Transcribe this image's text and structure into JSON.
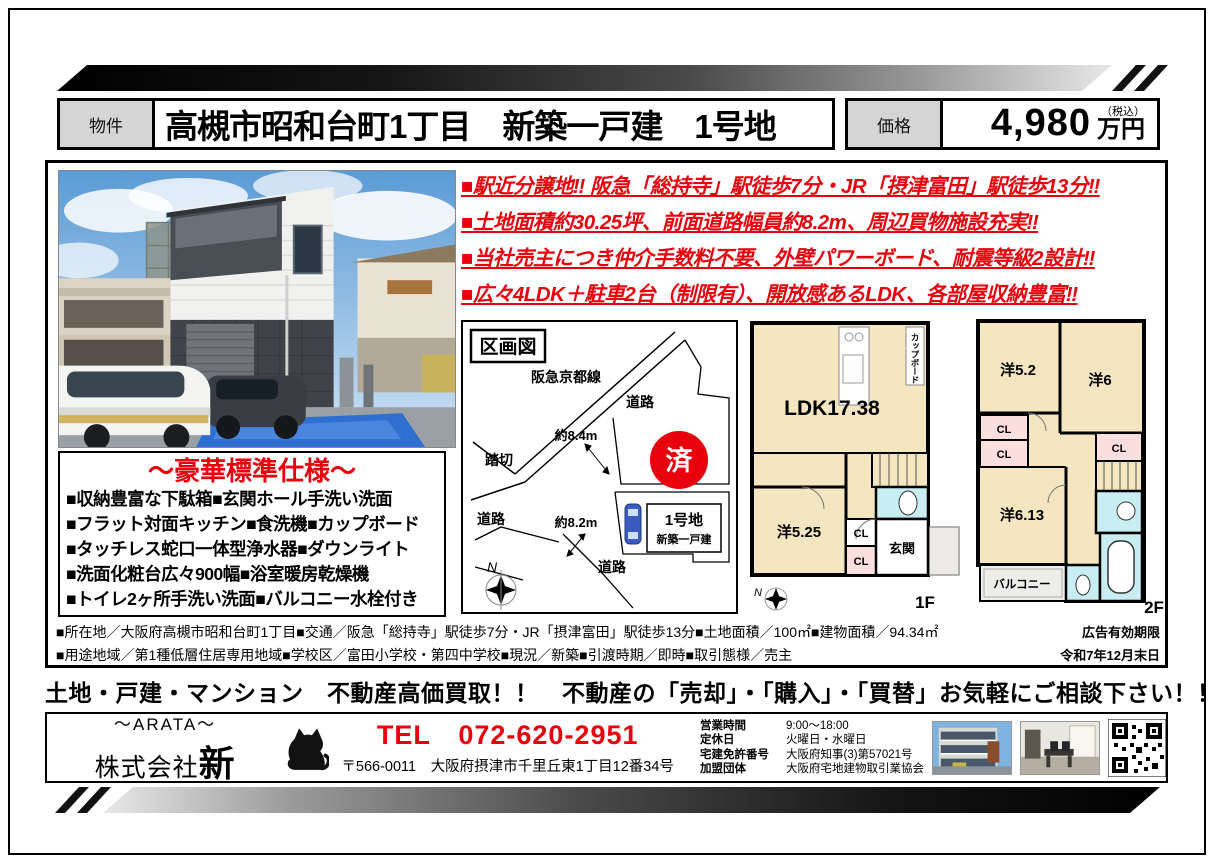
{
  "colors": {
    "accent_red": "#e8000d",
    "label_gray": "#d5d5d5",
    "room_cream": "#f3e6c0",
    "closet_pink": "#fbdede",
    "bath_cyan": "#c9eef2"
  },
  "header": {
    "property_label": "物件",
    "title": "高槻市昭和台町1丁目　新築一戸建　1号地",
    "price_label": "価格",
    "price_value": "4,980",
    "price_unit": "万円",
    "tax_note": "（税込）"
  },
  "highlights": {
    "line1": "■駅近分譲地‼ 阪急「総持寺」駅徒歩7分・JR「摂津富田」駅徒歩13分‼",
    "line2": "■土地面積約30.25坪、前面道路幅員約8.2m、周辺買物施設充実‼",
    "line3": "■当社売主につき仲介手数料不要、外壁パワーボード、耐震等級2設計‼",
    "line4": "■広々4LDK＋駐車2台（制限有）、開放感あるLDK、各部屋収納豊富‼"
  },
  "spec_box": {
    "title": "～豪華標準仕様～",
    "line1": "■収納豊富な下駄箱■玄関ホール手洗い洗面",
    "line2": "■フラット対面キッチン■食洗機■カップボード",
    "line3": "■タッチレス蛇口一体型浄水器■ダウンライト",
    "line4": "■洗面化粧台広々900幅■浴室暖房乾燥機",
    "line5": "■トイレ2ヶ所手洗い洗面■バルコニー水栓付き"
  },
  "site_map": {
    "title": "区画図",
    "railway": "阪急京都線",
    "road_top": "道路",
    "road_left": "道路",
    "road_bottom": "道路",
    "crossing": "踏切",
    "width1": "約8.4m",
    "width2": "約8.2m",
    "sold": "済",
    "lot_name": "1号地",
    "lot_sub": "新築一戸建",
    "compass_n": "N"
  },
  "floor1": {
    "label": "1F",
    "ldk": "LDK17.38",
    "cupboard": "カップボード",
    "room1": "洋5.25",
    "cl1": "CL",
    "cl2": "CL",
    "entrance": "玄関",
    "compass_n": "N"
  },
  "floor2": {
    "label": "2F",
    "room1": "洋5.2",
    "room2": "洋6",
    "room3": "洋6.13",
    "cl1": "CL",
    "cl2": "CL",
    "cl3": "CL",
    "balcony": "バルコニー"
  },
  "details": {
    "line1": "■所在地／大阪府高槻市昭和台町1丁目■交通／阪急「総持寺」駅徒歩7分・JR「摂津富田」駅徒歩13分■土地面積／100㎡■建物面積／94.34㎡",
    "line1_right": "広告有効期限",
    "line2": "■用途地域／第1種低層住居専用地域■学校区／富田小学校・第四中学校■現況／新築■引渡時期／即時■取引態様／売主",
    "line2_right": "令和7年12月末日"
  },
  "banner": "土地・戸建・マンション　不動産高価買取！！　不動産の「売却」・「購入」・「買替」お気軽にご相談下さい！！",
  "footer": {
    "company_kana": "～ARATA～",
    "company_prefix": "株式会社",
    "company_main": "新",
    "tel": "TEL　072-620-2951",
    "address": "〒566-0011　大阪府摂津市千里丘東1丁目12番34号",
    "info": [
      {
        "label": "営業時間",
        "value": "9:00～18:00"
      },
      {
        "label": "定休日",
        "value": "火曜日・水曜日"
      },
      {
        "label": "宅建免許番号",
        "value": "大阪府知事(3)第57021号"
      },
      {
        "label": "加盟団体",
        "value": "大阪府宅地建物取引業協会"
      }
    ]
  }
}
